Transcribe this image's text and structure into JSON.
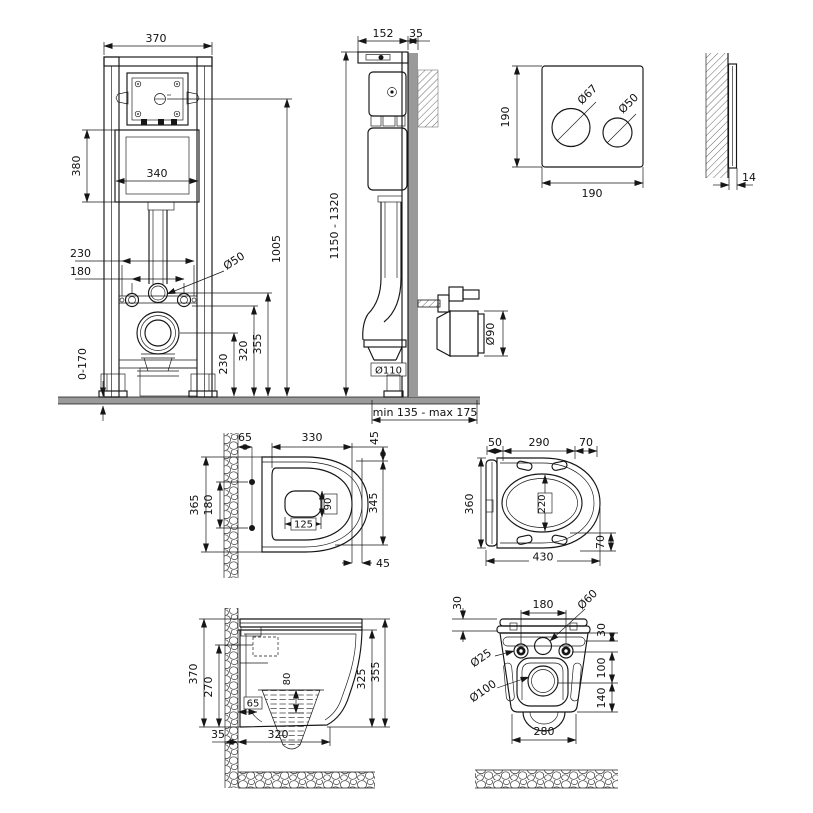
{
  "colors": {
    "line": "#161616",
    "wall_gray": "#9a9a9a",
    "background": "#ffffff"
  },
  "frame_front": {
    "frame_width": "370",
    "cistern_height": "380",
    "cistern_width": "340",
    "anchor_spacing": "230",
    "bolt_spacing": "180",
    "flush_pipe_dia": "Ø50",
    "feet_adjust": "0-170",
    "drain_center_height": "230",
    "bolt_height": "320",
    "flush_elbow_height": "355",
    "actuator_height": "1005"
  },
  "frame_side": {
    "frame_depth": "152",
    "wall_thickness": "35",
    "frame_height": "1150 - 1320",
    "outlet_dia": "Ø110",
    "drain_pipe_dia": "Ø90",
    "outlet_range": "min 135 - max 175"
  },
  "flush_plate": {
    "height": "190",
    "width": "190",
    "big_button_dia": "Ø67",
    "small_button_dia": "Ø50",
    "thickness": "14"
  },
  "bowl_top": {
    "wall_to_bolts": "65",
    "rim_length": "330",
    "rim_front_offset": "45",
    "bowl_width": "365",
    "bolt_spacing": "180",
    "opening_length": "125",
    "opening_width": "90",
    "rim_span": "345",
    "front_offset": "45"
  },
  "seat_top": {
    "hinge_offset": "50",
    "pad_span": "290",
    "front_span": "70",
    "seat_width": "360",
    "opening_width": "220",
    "seat_length": "430",
    "front_height": "70"
  },
  "bowl_side": {
    "total_height": "370",
    "rear_height": "270",
    "water_depth": "80",
    "trap_offset": "65",
    "wall_thickness": "35",
    "bottom_length": "320",
    "rim_height": "325",
    "overall_height": "355"
  },
  "bowl_rear": {
    "lid_thickness": "30",
    "bolt_spacing": "180",
    "inlet_dia": "Ø60",
    "top_offset": "30",
    "bolt_hole_dia": "Ø25",
    "inlet_to_outlet": "100",
    "outlet_dia": "Ø100",
    "outlet_to_bottom": "140",
    "body_width": "280"
  }
}
